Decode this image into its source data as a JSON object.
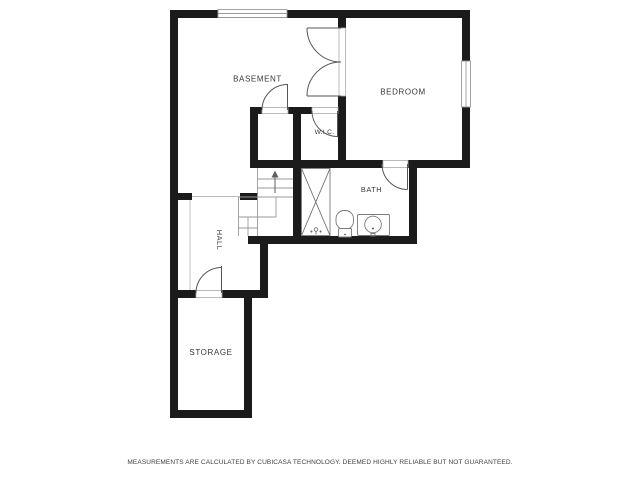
{
  "page": {
    "background": "#ffffff",
    "disclaimer": "MEASUREMENTS ARE CALCULATED BY CUBICASA TECHNOLOGY. DEEMED HIGHLY RELIABLE BUT NOT GUARANTEED."
  },
  "colors": {
    "wall": "#1b1b1b",
    "door_line": "#565656",
    "window_frame": "#999999",
    "stair_line": "#9a9a9a",
    "open_boundary_line": "#bcbcbc",
    "fixture_line": "#7a7a7a",
    "label_text": "#383838",
    "disclaimer_text": "#3f3f3f"
  },
  "rooms": [
    {
      "label": "BASEMENT"
    },
    {
      "label": "BEDROOM"
    },
    {
      "label": "W.I.C."
    },
    {
      "label": "BATH"
    },
    {
      "label": "HALL"
    },
    {
      "label": "STORAGE"
    }
  ],
  "fixtures": {
    "shower": "shower-stall-with-cross",
    "toilet": "toilet",
    "sink": "sink-basin",
    "stairs": "staircase-with-up-arrow"
  },
  "windows_count": 2,
  "doors_count": 5
}
